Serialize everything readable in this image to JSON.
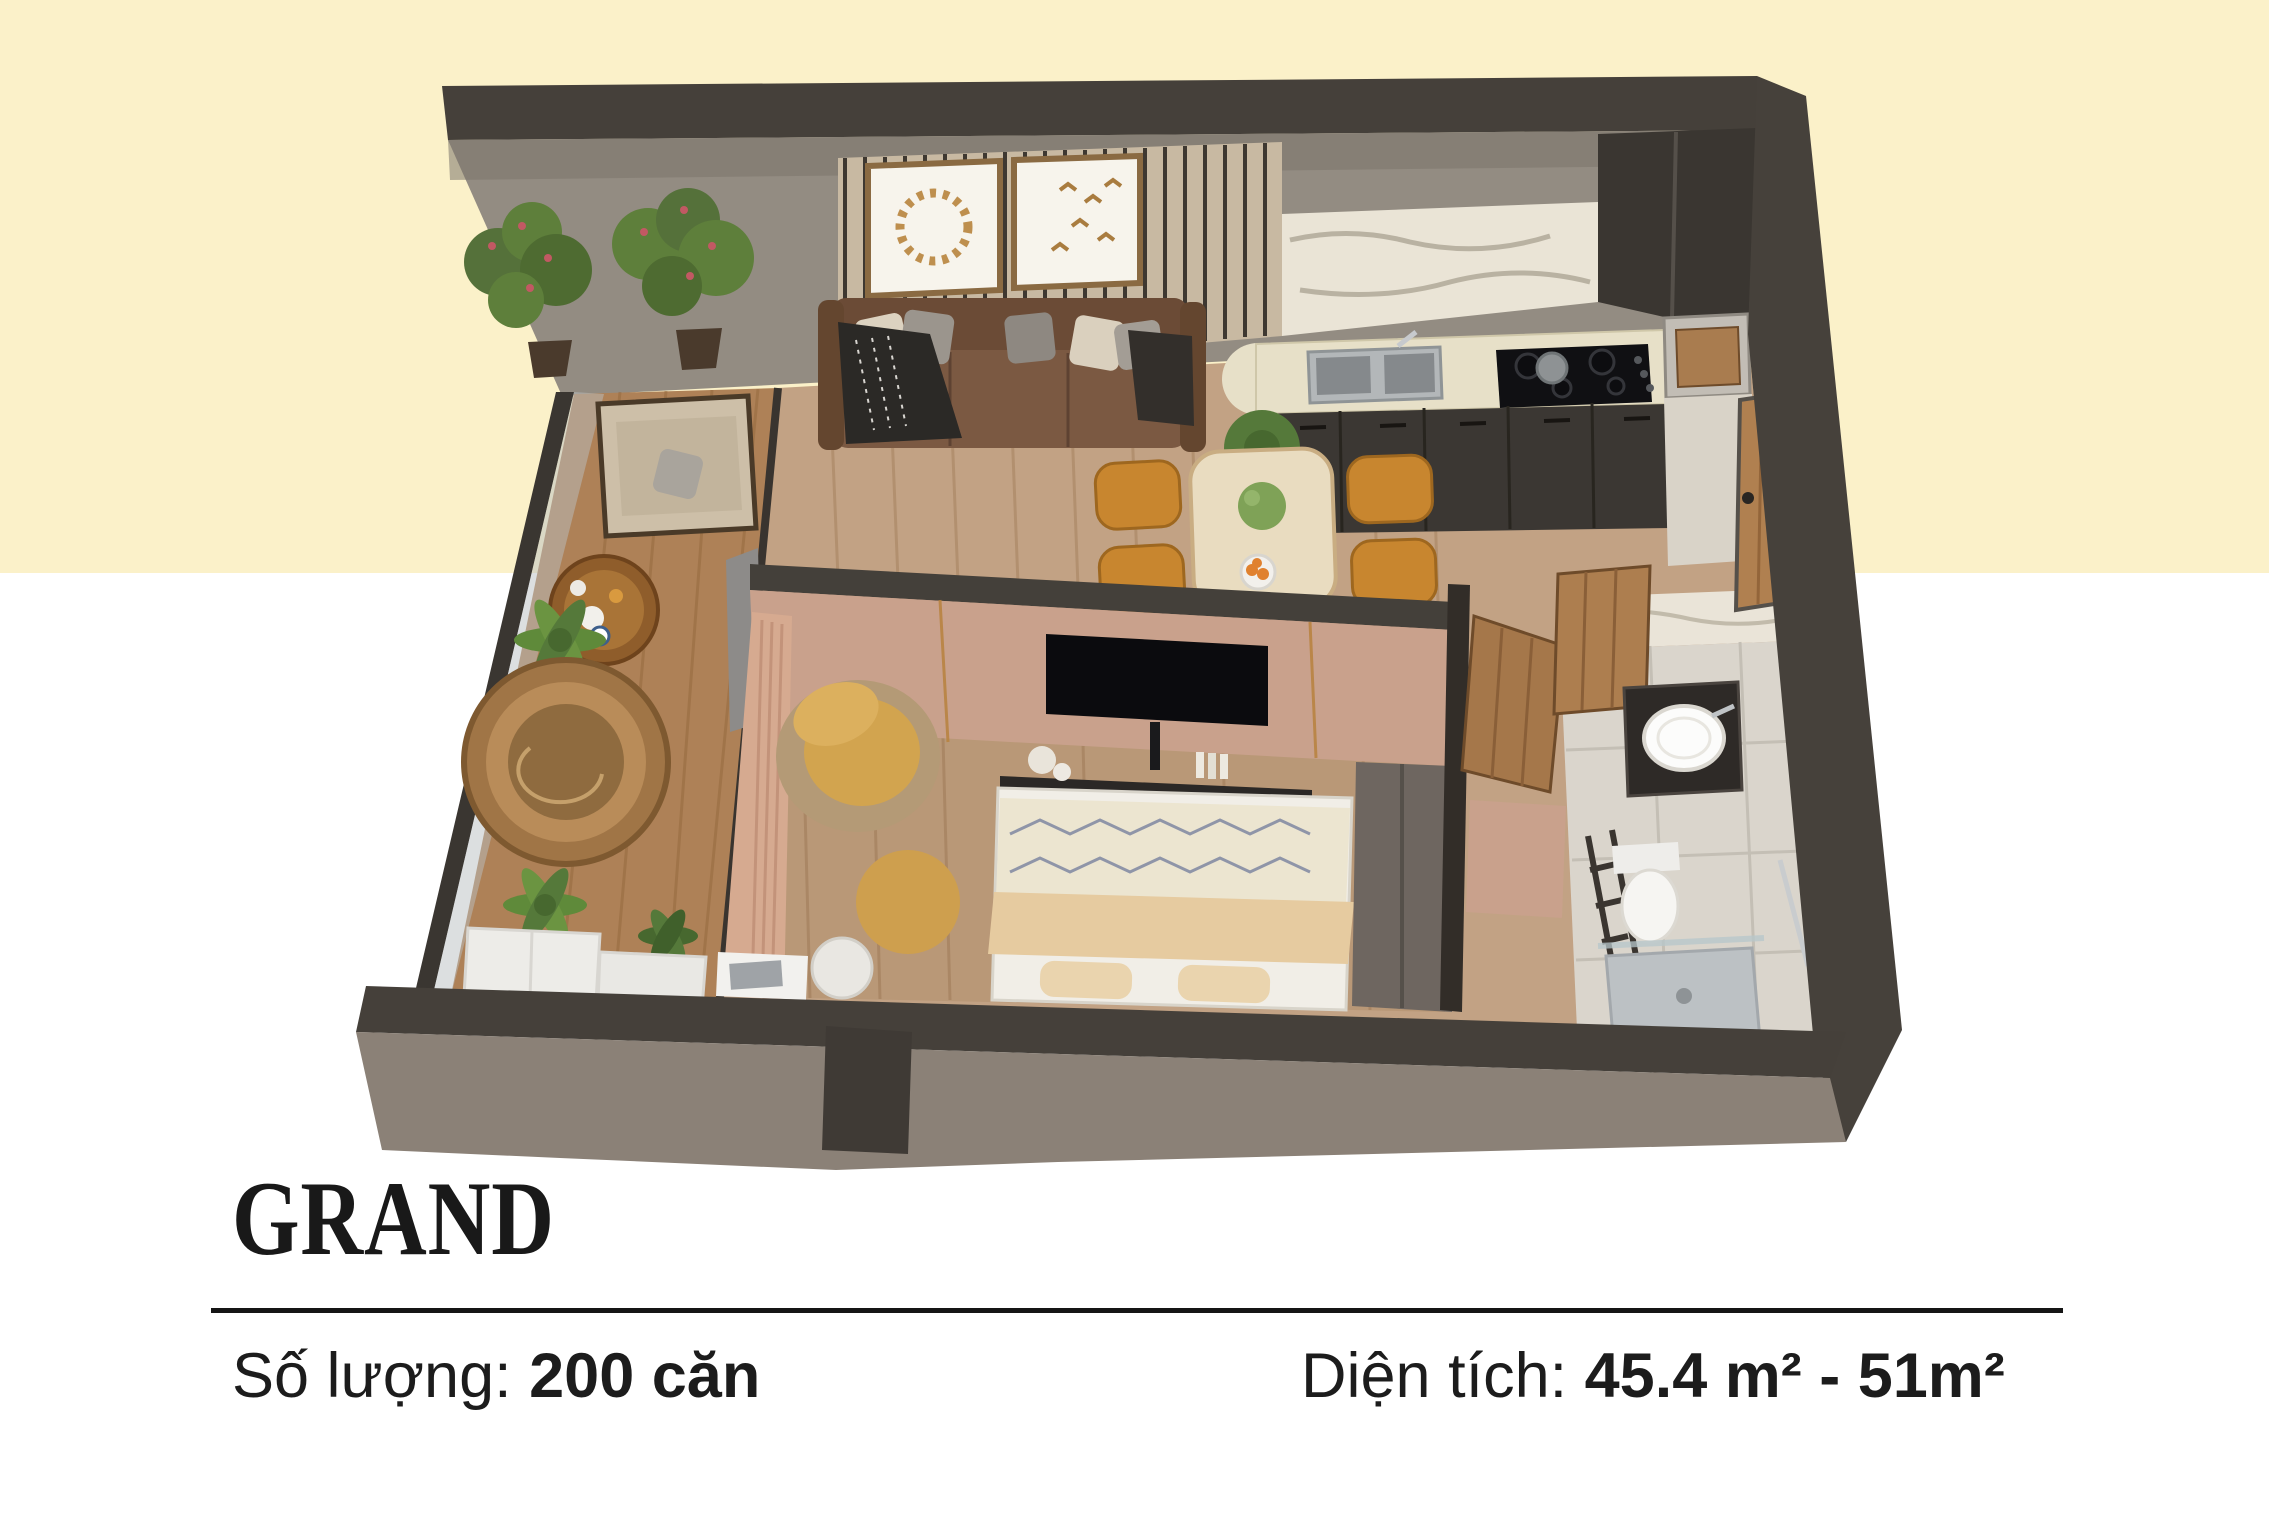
{
  "info": {
    "title": "GRAND",
    "quantity_label": "Số lượng: ",
    "quantity_value": "200 căn",
    "area_label": "Diện tích: ",
    "area_value": "45.4 m² - 51m²"
  },
  "palette": {
    "background_top": "#FBF1C9",
    "background_bottom": "#FFFFFF",
    "text": "#1C1C1C",
    "wall_dark": "#45403A",
    "wall_face_gray": "#8F887E",
    "facade_gray": "#8B8177",
    "wood_floor": "#C2A284",
    "balcony_floor": "#AE8157",
    "bathroom_tile": "#DAD5CC",
    "slat_wall": "#C8B9A2",
    "marble": "#EAE4D6",
    "countertop": "#E7E0C8",
    "cabinet_dark": "#3B3733",
    "sofa_brown": "#7B5942",
    "dining_chair_amber": "#C8862F",
    "cushion_mustard": "#D2A44F",
    "blush_wall": "#C9A18C",
    "wood_door": "#B08050",
    "plant_green": "#5E7F3B",
    "bed_beige": "#E6CBA0",
    "glass": "#B9C0C2"
  }
}
